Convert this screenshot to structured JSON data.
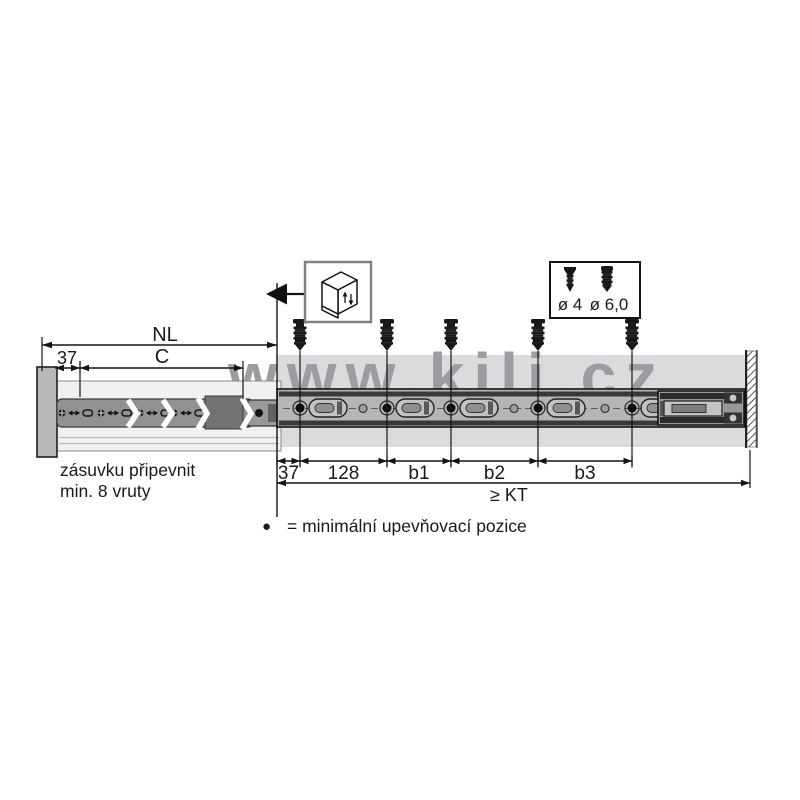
{
  "watermark": "www.kili.cz",
  "dims": {
    "nl": "NL",
    "front_offset": "37",
    "c": "C",
    "bottom": [
      "37",
      "128",
      "b1",
      "b2",
      "b3"
    ],
    "kt": "≥ KT"
  },
  "screw_box": {
    "small_label": "ø 4",
    "large_label": "ø 6,0"
  },
  "notes": {
    "line1": "zásuvku připevnit",
    "line2": "min. 8 vruty"
  },
  "legend": {
    "bullet": "●",
    "text": "= minimální upevňovací pozice"
  },
  "colors": {
    "band": "#dadbdc",
    "watermark": "#9b9da0",
    "ink": "#1a1a1a",
    "rail_gray": "#b3b5b6",
    "dark_bar": "#39393b"
  }
}
